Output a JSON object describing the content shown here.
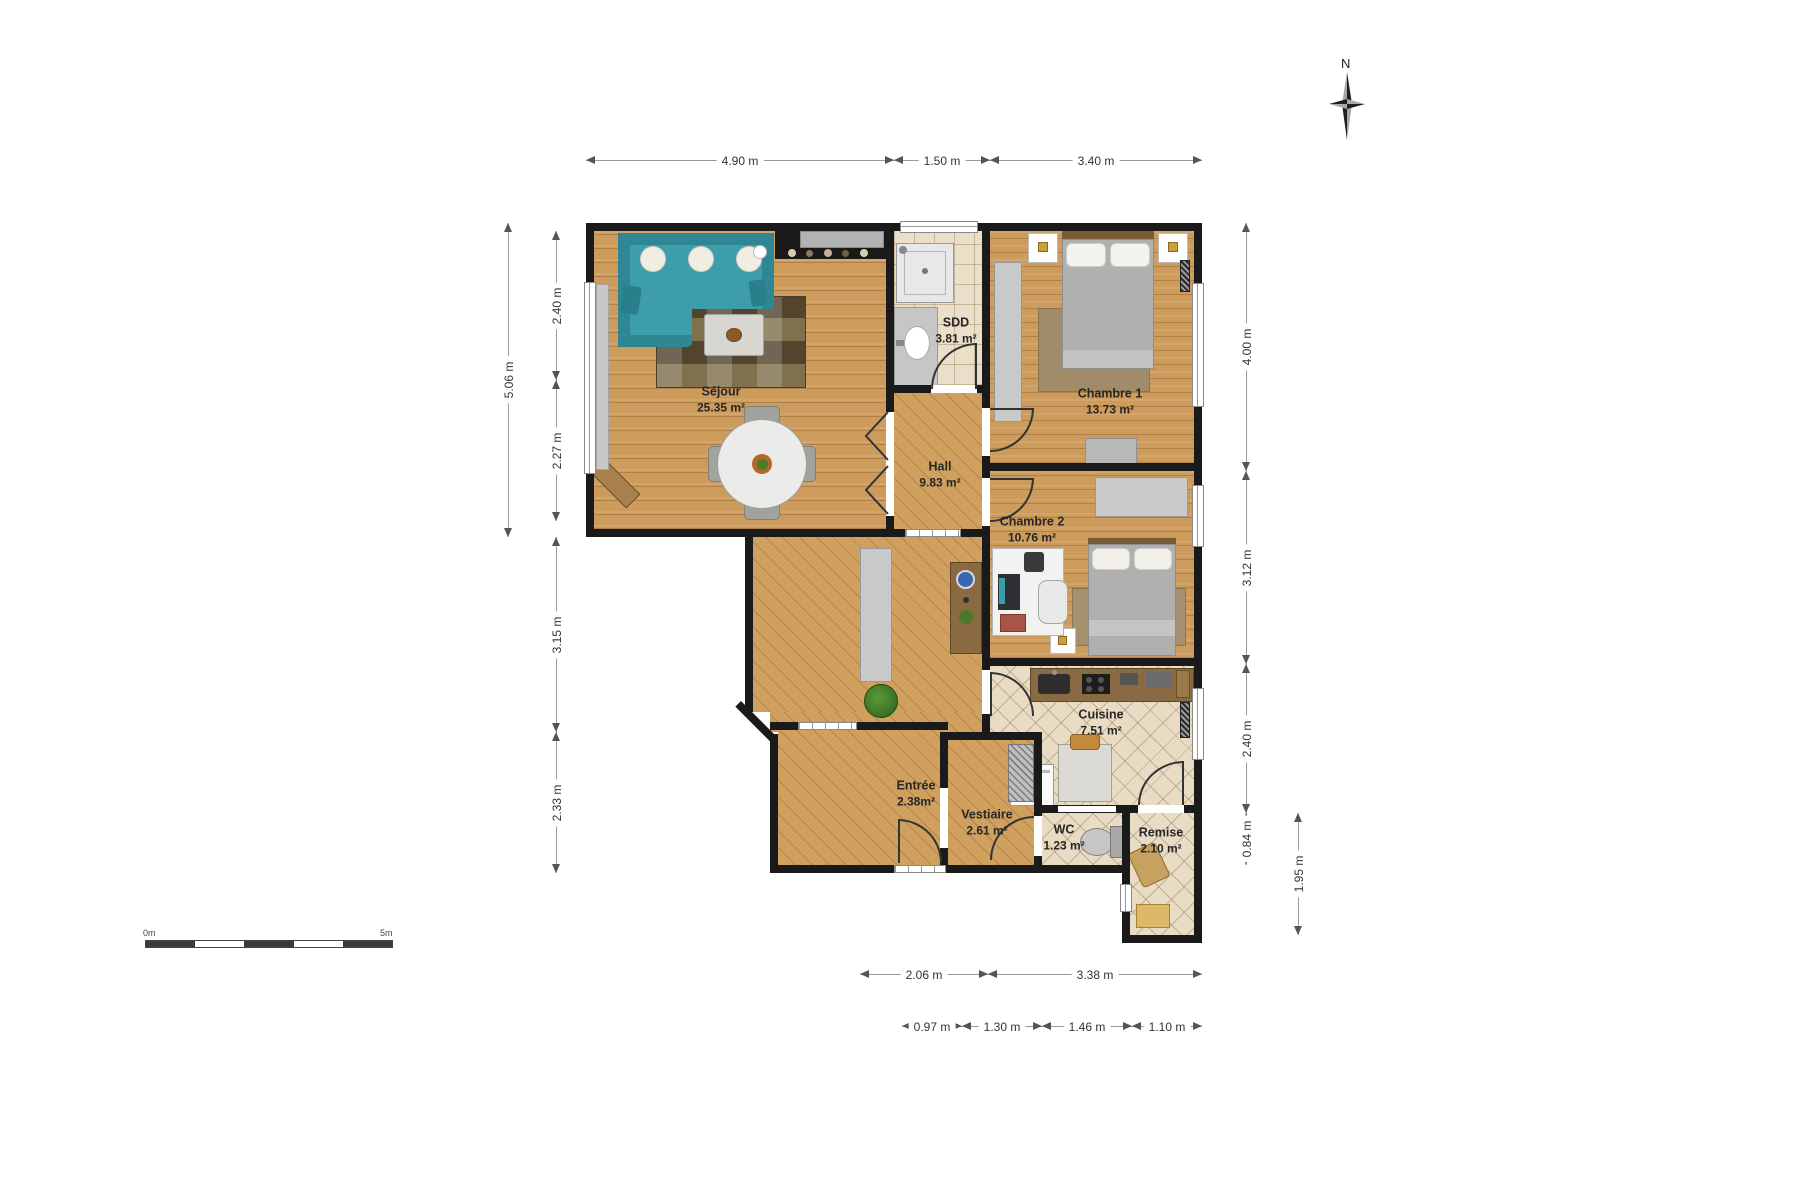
{
  "rooms": {
    "sejour": {
      "name": "Séjour",
      "area": "25.35 m²"
    },
    "sdd": {
      "name": "SDD",
      "area": "3.81 m²"
    },
    "chambre1": {
      "name": "Chambre 1",
      "area": "13.73 m²"
    },
    "hall": {
      "name": "Hall",
      "area": "9.83 m²"
    },
    "chambre2": {
      "name": "Chambre 2",
      "area": "10.76 m²"
    },
    "cuisine": {
      "name": "Cuisine",
      "area": "7.51 m²"
    },
    "entree": {
      "name": "Entrée",
      "area": "2.38m²"
    },
    "vestiaire": {
      "name": "Vestiaire",
      "area": "2.61 m²"
    },
    "wc": {
      "name": "WC",
      "area": "1.23 m²"
    },
    "remise": {
      "name": "Remise",
      "area": "2.10 m²"
    }
  },
  "dims": {
    "top": [
      "4.90 m",
      "1.50 m",
      "3.40 m"
    ],
    "left_outer": "5.06 m",
    "left": [
      "2.40 m",
      "2.27 m",
      "3.15 m",
      "2.33 m"
    ],
    "right": [
      "4.00 m",
      "3.12 m",
      "2.40 m",
      "0.84 m"
    ],
    "right_outer": "1.95 m",
    "bottom_upper": [
      "2.06 m",
      "3.38 m"
    ],
    "bottom_lower": [
      "0.97 m",
      "1.30 m",
      "1.46 m",
      "1.10 m"
    ]
  },
  "compass": {
    "north_label": "N"
  },
  "scale_bar": {
    "start_label": "0m",
    "end_label": "5m"
  },
  "colors": {
    "wall": "#1a1a1a",
    "wood_floor": "#cd9b5c",
    "tile_floor": "#ebdfc9",
    "sofa_teal": "#3d9dab",
    "dim_text": "#333333"
  }
}
